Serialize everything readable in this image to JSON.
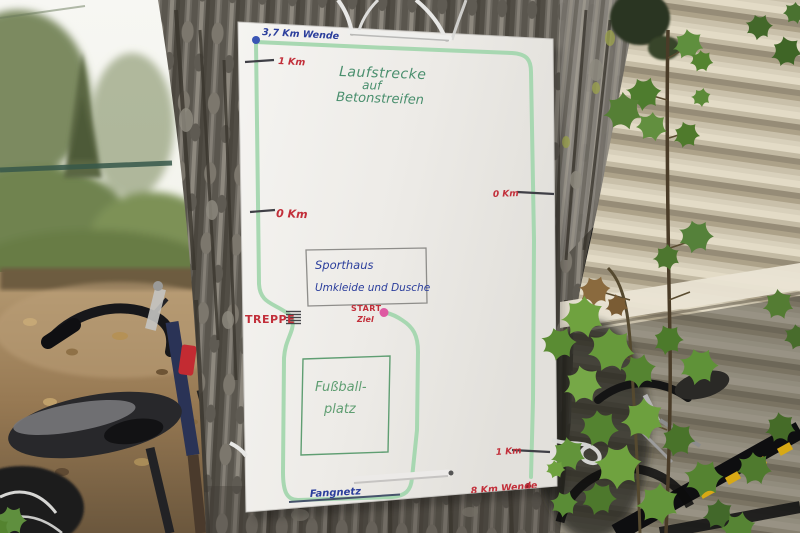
{
  "map_sign": {
    "title_lines": {
      "line1": "Laufstrecke",
      "line2": "auf",
      "line3": "Betonstreifen"
    },
    "markers": {
      "wende_top": "3,7 Km Wende",
      "km1_left": "1 Km",
      "km0_left": "0 Km",
      "km0_right": "0 Km",
      "km1_right": "1 Km",
      "wende_bottom": "8 Km Wende",
      "treppe": "TREPPE",
      "start": "START",
      "ziel": "Ziel",
      "fangnetz": "Fangnetz"
    },
    "buildings": {
      "sporthaus_line1": "Sporthaus",
      "sporthaus_line2": "Umkleide und Dusche",
      "fussball_line1": "Fußball-",
      "fussball_line2": "platz"
    },
    "colors": {
      "route_green": "#a3d6ae",
      "title_green": "#4a8f6e",
      "handwriting_blue": "#2b3e9c",
      "handwriting_red": "#c22f3a",
      "field_green": "#5f9e72",
      "start_dot_pink": "#de5aa2",
      "wende_dot_blue": "#3a55b4",
      "wende_dot_dark_red": "#8e1f28",
      "tick_gray": "#3f3f46"
    }
  }
}
